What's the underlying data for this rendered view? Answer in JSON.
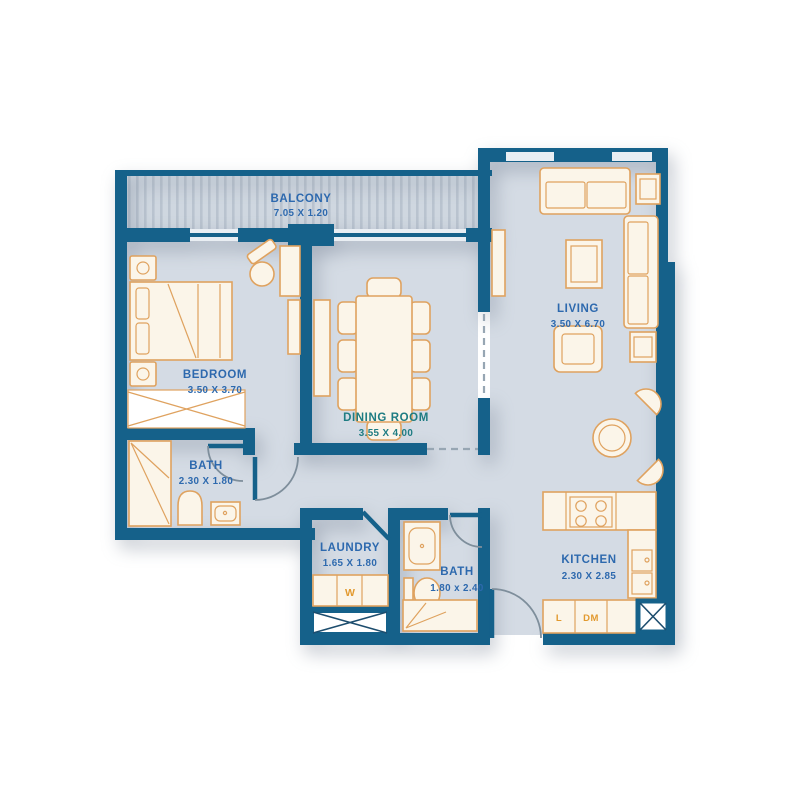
{
  "colors": {
    "wall": "#15618a",
    "floor": "#d4dbe4",
    "balconyBase": "#cfd7e0",
    "balconyStripe": "#b9c3cf",
    "furnitureFill": "#fbf5e9",
    "furnitureStroke": "#dfa25f",
    "labelBlue": "#2d69ae",
    "labelTeal": "#1e7c82",
    "accentOrange": "#e2992e",
    "doorArc": "#7e8e9b",
    "dashedLine": "#97a6b3",
    "windowLight": "#e9eef3",
    "shaftLine": "#1d4d6e",
    "background": "#ffffff"
  },
  "rooms": {
    "balcony": {
      "name": "BALCONY",
      "dims": "7.05 X 1.20"
    },
    "bedroom": {
      "name": "BEDROOM",
      "dims": "3.50 X 3.70"
    },
    "dining": {
      "name": "DINING ROOM",
      "dims": "3.55 X 4.00"
    },
    "living": {
      "name": "LIVING",
      "dims": "3.50 X 6.70"
    },
    "bath1": {
      "name": "BATH",
      "dims": "2.30 X 1.80"
    },
    "laundry": {
      "name": "LAUNDRY",
      "dims": "1.65 X 1.80"
    },
    "bath2": {
      "name": "BATH",
      "dims": "1.80 x 2.40"
    },
    "kitchen": {
      "name": "KITCHEN",
      "dims": "2.30 X 2.85"
    }
  },
  "appliances": {
    "washer": "W",
    "kitchen_unit_1": "L",
    "kitchen_unit_2": "DM"
  }
}
